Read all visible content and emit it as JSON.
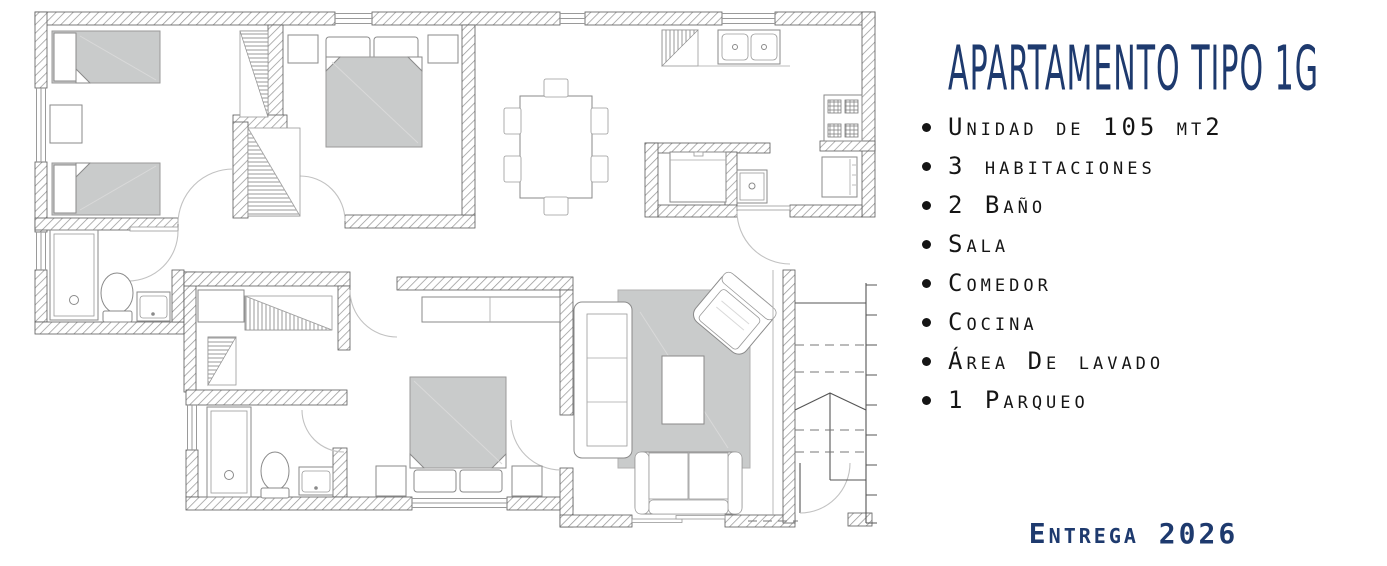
{
  "panel": {
    "title": "APARTAMENTO TIPO 1G",
    "features": [
      "Unidad de 105 mt2",
      "3 habitaciones",
      "2 Baño",
      "Sala",
      "Comedor",
      "Cocina",
      "Área De lavado",
      "1 Parqueo"
    ],
    "delivery": "Entrega 2026"
  },
  "colors": {
    "accent_navy": "#1e3a6e",
    "bullet_text": "#151515",
    "furniture_gray": "#c9cbcb",
    "wall_outline": "#5a5a5a",
    "hatch_line": "#979797"
  }
}
